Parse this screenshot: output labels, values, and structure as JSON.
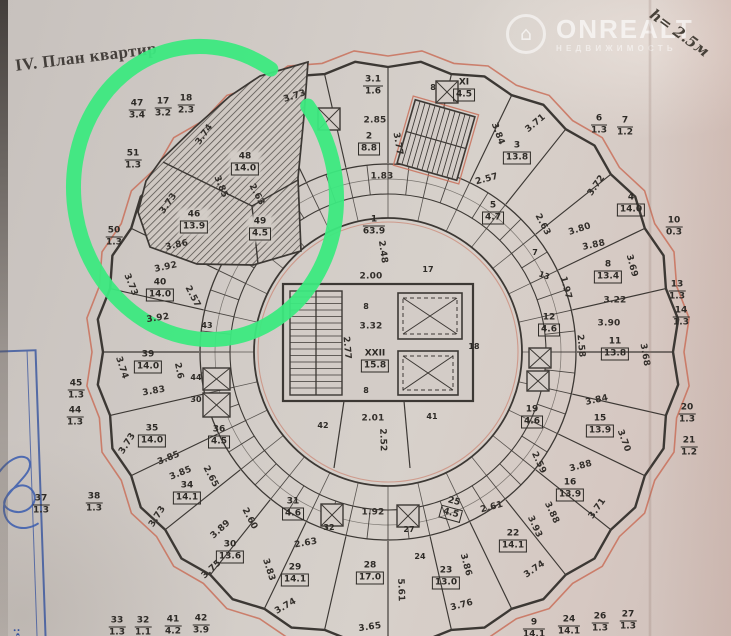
{
  "page": {
    "section_header": "IV. План квартир",
    "height_note": "h= 2.5м"
  },
  "watermark": {
    "icon_glyph": "⌂",
    "brand": "ONREALT",
    "subtitle": "НЕДВИЖИМОСТЬ"
  },
  "stamp": {
    "label": "тель:"
  },
  "colors": {
    "paper": "#d3ccc7",
    "ink": "#3c3834",
    "ink_red": "#c9705a",
    "marker_green": "#3ce97f",
    "stamp_blue": "#35529e"
  },
  "plan": {
    "fractions": [
      {
        "n": "47",
        "d": "3.4",
        "x": 137,
        "y": 110
      },
      {
        "n": "17",
        "d": "3.2",
        "x": 163,
        "y": 108
      },
      {
        "n": "18",
        "d": "2.3",
        "x": 186,
        "y": 105
      },
      {
        "n": "51",
        "d": "1.3",
        "x": 133,
        "y": 160
      },
      {
        "n": "50",
        "d": "1.3",
        "x": 114,
        "y": 237
      },
      {
        "n": "45",
        "d": "1.3",
        "x": 76,
        "y": 390
      },
      {
        "n": "44",
        "d": "1.3",
        "x": 75,
        "y": 417
      },
      {
        "n": "37",
        "d": "1.3",
        "x": 41,
        "y": 505
      },
      {
        "n": "38",
        "d": "1.3",
        "x": 94,
        "y": 503
      },
      {
        "n": "33",
        "d": "1.3",
        "x": 117,
        "y": 627
      },
      {
        "n": "32",
        "d": "1.1",
        "x": 143,
        "y": 627
      },
      {
        "n": "41",
        "d": "4.2",
        "x": 173,
        "y": 626
      },
      {
        "n": "42",
        "d": "3.9",
        "x": 201,
        "y": 625
      },
      {
        "n": "9",
        "d": "14.1",
        "x": 534,
        "y": 629
      },
      {
        "n": "24",
        "d": "14.1",
        "x": 569,
        "y": 626
      },
      {
        "n": "26",
        "d": "1.3",
        "x": 600,
        "y": 623
      },
      {
        "n": "27",
        "d": "1.3",
        "x": 628,
        "y": 621
      },
      {
        "n": "21",
        "d": "1.2",
        "x": 689,
        "y": 447
      },
      {
        "n": "20",
        "d": "1.3",
        "x": 687,
        "y": 414
      },
      {
        "n": "14",
        "d": "1.3",
        "x": 681,
        "y": 317
      },
      {
        "n": "13",
        "d": "1.3",
        "x": 677,
        "y": 291
      },
      {
        "n": "10",
        "d": "0.3",
        "x": 674,
        "y": 227
      },
      {
        "n": "7",
        "d": "1.2",
        "x": 625,
        "y": 127
      },
      {
        "n": "6",
        "d": "1.3",
        "x": 599,
        "y": 125
      },
      {
        "n": "XI",
        "d": "4.5",
        "x": 464,
        "y": 90,
        "box": true
      },
      {
        "n": "3.1",
        "d": "1.6",
        "x": 373,
        "y": 86
      },
      {
        "n": "2",
        "d": "8.8",
        "x": 369,
        "y": 144,
        "box": true
      },
      {
        "n": "1",
        "d": "63.9",
        "x": 374,
        "y": 226
      },
      {
        "n": "XXII",
        "d": "15.8",
        "x": 375,
        "y": 361,
        "box": true
      },
      {
        "n": "3",
        "d": "13.8",
        "x": 517,
        "y": 153,
        "box": true
      },
      {
        "n": "4",
        "d": "14.0",
        "x": 631,
        "y": 205,
        "box": true
      },
      {
        "n": "5",
        "d": "4.7",
        "x": 493,
        "y": 213,
        "box": true
      },
      {
        "n": "8",
        "d": "13.4",
        "x": 608,
        "y": 272,
        "box": true
      },
      {
        "n": "12",
        "d": "4.6",
        "x": 549,
        "y": 325,
        "box": true
      },
      {
        "n": "11",
        "d": "13.8",
        "x": 615,
        "y": 349,
        "box": true
      },
      {
        "n": "19",
        "d": "4.6",
        "x": 532,
        "y": 417,
        "box": true
      },
      {
        "n": "15",
        "d": "13.9",
        "x": 600,
        "y": 426,
        "box": true
      },
      {
        "n": "16",
        "d": "13.9",
        "x": 570,
        "y": 490,
        "box": true
      },
      {
        "n": "22",
        "d": "14.1",
        "x": 513,
        "y": 541,
        "box": true
      },
      {
        "n": "23",
        "d": "13.0",
        "x": 446,
        "y": 578,
        "box": true
      },
      {
        "n": "25",
        "d": "4.5",
        "x": 452,
        "y": 509,
        "box": true,
        "r": 15
      },
      {
        "n": "28",
        "d": "17.0",
        "x": 370,
        "y": 573,
        "box": true
      },
      {
        "n": "29",
        "d": "14.1",
        "x": 295,
        "y": 575,
        "box": true
      },
      {
        "n": "31",
        "d": "4.6",
        "x": 293,
        "y": 509,
        "box": true
      },
      {
        "n": "30",
        "d": "13.6",
        "x": 230,
        "y": 552,
        "box": true
      },
      {
        "n": "34",
        "d": "14.1",
        "x": 187,
        "y": 493,
        "box": true
      },
      {
        "n": "35",
        "d": "14.0",
        "x": 152,
        "y": 436,
        "box": true
      },
      {
        "n": "36",
        "d": "4.5",
        "x": 219,
        "y": 437,
        "box": true
      },
      {
        "n": "39",
        "d": "14.0",
        "x": 148,
        "y": 362,
        "box": true
      },
      {
        "n": "40",
        "d": "14.0",
        "x": 160,
        "y": 290,
        "box": true
      },
      {
        "n": "48",
        "d": "14.0",
        "x": 245,
        "y": 164,
        "box": true,
        "chip": true
      },
      {
        "n": "46",
        "d": "13.9",
        "x": 194,
        "y": 222,
        "box": true,
        "chip": true
      },
      {
        "n": "49",
        "d": "4.5",
        "x": 260,
        "y": 229,
        "box": true,
        "chip": true
      }
    ],
    "dims": [
      {
        "t": "1.83",
        "x": 382,
        "y": 177
      },
      {
        "t": "2.85",
        "x": 375,
        "y": 121
      },
      {
        "t": "3.77",
        "x": 397,
        "y": 144,
        "r": 80
      },
      {
        "t": "3.73",
        "x": 295,
        "y": 97,
        "r": -18
      },
      {
        "t": "3.71",
        "x": 536,
        "y": 124,
        "r": -40
      },
      {
        "t": "3.84",
        "x": 497,
        "y": 134,
        "r": 70
      },
      {
        "t": "3.72",
        "x": 597,
        "y": 186,
        "r": -55
      },
      {
        "t": "2.63",
        "x": 542,
        "y": 225,
        "r": 62
      },
      {
        "t": "3.80",
        "x": 580,
        "y": 230,
        "r": -18
      },
      {
        "t": "2.57",
        "x": 487,
        "y": 180,
        "r": -15
      },
      {
        "t": "2.57",
        "x": 192,
        "y": 297,
        "r": 62
      },
      {
        "t": "3.88",
        "x": 594,
        "y": 246,
        "r": -12
      },
      {
        "t": "3.69",
        "x": 631,
        "y": 266,
        "r": 75
      },
      {
        "t": "3.22",
        "x": 615,
        "y": 301
      },
      {
        "t": "3.90",
        "x": 609,
        "y": 324
      },
      {
        "t": "2.58",
        "x": 580,
        "y": 346,
        "r": 85
      },
      {
        "t": "3.68",
        "x": 644,
        "y": 355,
        "r": 80
      },
      {
        "t": "1.97",
        "x": 565,
        "y": 288,
        "r": 75
      },
      {
        "t": "3.84",
        "x": 597,
        "y": 401,
        "r": -12
      },
      {
        "t": "3.70",
        "x": 623,
        "y": 441,
        "r": 70
      },
      {
        "t": "2.59",
        "x": 538,
        "y": 463,
        "r": 65
      },
      {
        "t": "2.61",
        "x": 492,
        "y": 508,
        "r": -15
      },
      {
        "t": "3.88",
        "x": 581,
        "y": 467,
        "r": -15
      },
      {
        "t": "3.71",
        "x": 598,
        "y": 509,
        "r": -55
      },
      {
        "t": "3.88",
        "x": 551,
        "y": 513,
        "r": 65
      },
      {
        "t": "3.93",
        "x": 534,
        "y": 527,
        "r": 65
      },
      {
        "t": "3.74",
        "x": 535,
        "y": 570,
        "r": -35
      },
      {
        "t": "3.86",
        "x": 465,
        "y": 565,
        "r": 75
      },
      {
        "t": "3.76",
        "x": 462,
        "y": 606,
        "r": -15
      },
      {
        "t": "5.61",
        "x": 400,
        "y": 590,
        "r": 88
      },
      {
        "t": "3.65",
        "x": 370,
        "y": 628,
        "r": -8
      },
      {
        "t": "1.92",
        "x": 373,
        "y": 513
      },
      {
        "t": "3.74",
        "x": 286,
        "y": 607,
        "r": -30
      },
      {
        "t": "3.83",
        "x": 268,
        "y": 570,
        "r": 72
      },
      {
        "t": "2.63",
        "x": 306,
        "y": 544,
        "r": -10
      },
      {
        "t": "2.60",
        "x": 249,
        "y": 519,
        "r": 62
      },
      {
        "t": "3.89",
        "x": 221,
        "y": 530,
        "r": -42
      },
      {
        "t": "3.75",
        "x": 212,
        "y": 570,
        "r": -42
      },
      {
        "t": "3.73",
        "x": 158,
        "y": 517,
        "r": -58
      },
      {
        "t": "3.85",
        "x": 169,
        "y": 459,
        "r": -22
      },
      {
        "t": "3.85",
        "x": 181,
        "y": 474,
        "r": -22
      },
      {
        "t": "2.65",
        "x": 210,
        "y": 477,
        "r": 62
      },
      {
        "t": "3.73",
        "x": 128,
        "y": 444,
        "r": -58
      },
      {
        "t": "3.74",
        "x": 121,
        "y": 368,
        "r": 72
      },
      {
        "t": "3.83",
        "x": 154,
        "y": 392,
        "r": -10
      },
      {
        "t": "2.6",
        "x": 178,
        "y": 371,
        "r": 78
      },
      {
        "t": "3.92",
        "x": 166,
        "y": 268,
        "r": -12
      },
      {
        "t": "3.92",
        "x": 158,
        "y": 319,
        "r": -8
      },
      {
        "t": "3.73",
        "x": 130,
        "y": 285,
        "r": 68
      },
      {
        "t": "2.48",
        "x": 382,
        "y": 252,
        "r": 82
      },
      {
        "t": "2.00",
        "x": 371,
        "y": 277
      },
      {
        "t": "3.32",
        "x": 371,
        "y": 327
      },
      {
        "t": "2.77",
        "x": 346,
        "y": 348,
        "r": 85
      },
      {
        "t": "2.01",
        "x": 373,
        "y": 419
      },
      {
        "t": "2.52",
        "x": 382,
        "y": 440,
        "r": 88
      },
      {
        "t": "2.63",
        "x": 256,
        "y": 195,
        "r": 62
      },
      {
        "t": "3.85",
        "x": 220,
        "y": 187,
        "r": 68
      },
      {
        "t": "3.73",
        "x": 169,
        "y": 204,
        "r": -55
      },
      {
        "t": "3.86",
        "x": 177,
        "y": 246,
        "r": -12
      },
      {
        "t": "3.74",
        "x": 205,
        "y": 135,
        "r": -55
      }
    ],
    "ids": [
      {
        "t": "17",
        "x": 428,
        "y": 270
      },
      {
        "t": "18",
        "x": 474,
        "y": 347
      },
      {
        "t": "8",
        "x": 366,
        "y": 307
      },
      {
        "t": "8",
        "x": 366,
        "y": 391
      },
      {
        "t": "8",
        "x": 433,
        "y": 88
      },
      {
        "t": "41",
        "x": 432,
        "y": 417
      },
      {
        "t": "42",
        "x": 323,
        "y": 426
      },
      {
        "t": "43",
        "x": 207,
        "y": 326
      },
      {
        "t": "44",
        "x": 196,
        "y": 378
      },
      {
        "t": "30",
        "x": 196,
        "y": 400
      },
      {
        "t": "27",
        "x": 409,
        "y": 530
      },
      {
        "t": "32",
        "x": 329,
        "y": 528
      },
      {
        "t": "24",
        "x": 420,
        "y": 557
      },
      {
        "t": "7",
        "x": 535,
        "y": 253
      },
      {
        "t": "13",
        "x": 544,
        "y": 276,
        "r": 20
      }
    ]
  }
}
